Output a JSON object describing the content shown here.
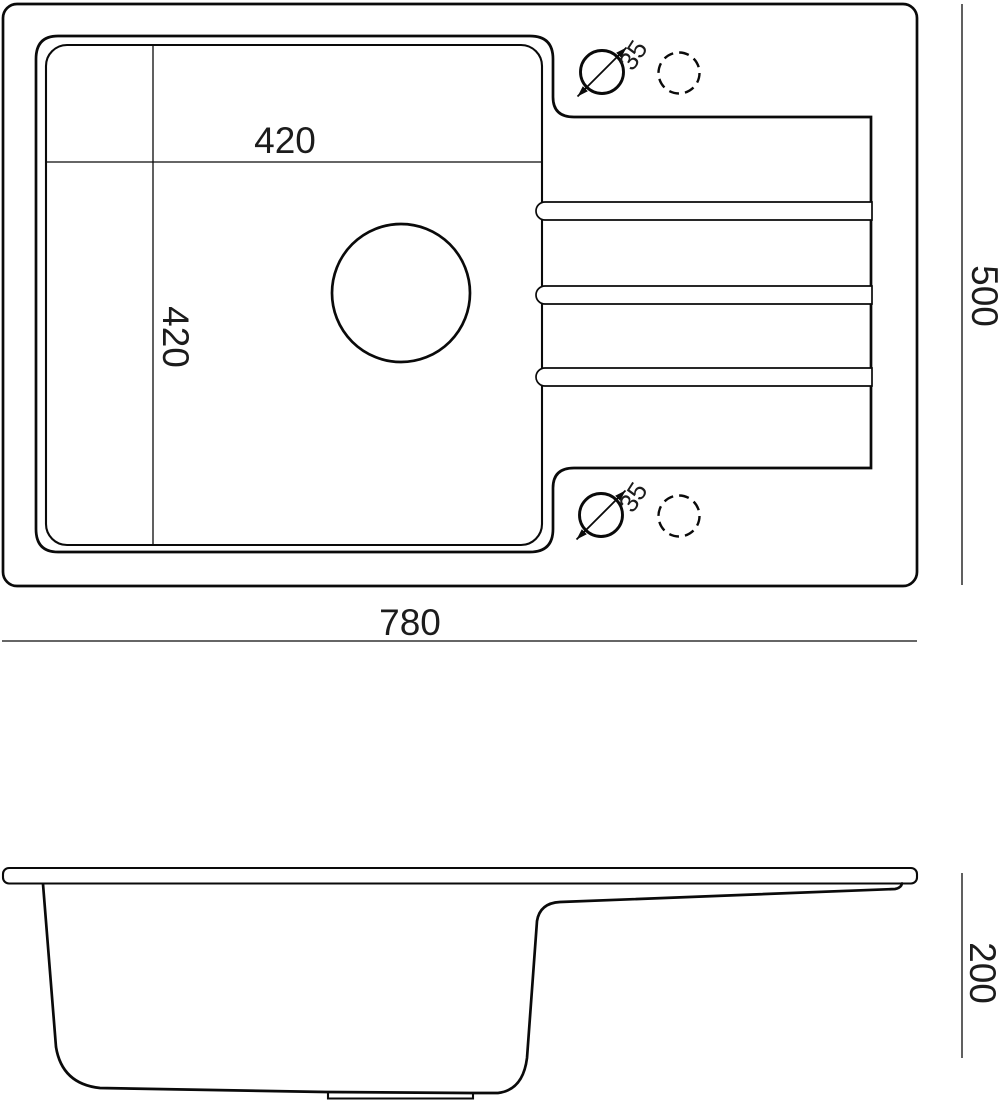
{
  "colors": {
    "line": "#0a0a0a",
    "background": "#ffffff",
    "text": "#1c1c1c"
  },
  "top_view": {
    "labels": {
      "basin_width": "420",
      "basin_depth": "420",
      "overall_width": "780",
      "overall_depth": "500",
      "tap_hole_top_diameter": "35",
      "tap_hole_bottom_diameter": "35"
    }
  },
  "side_view": {
    "labels": {
      "depth": "200"
    }
  }
}
